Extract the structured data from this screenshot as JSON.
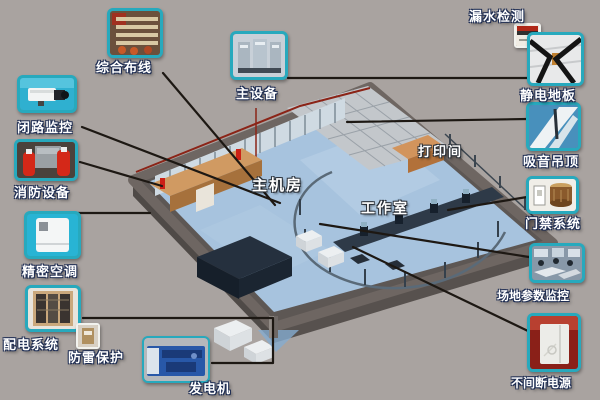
{
  "diagram": {
    "description": "isometric-machine-room-solution-diagram",
    "room_labels": {
      "main_room": "主机房",
      "work_room": "工作室",
      "print_room": "打印间"
    },
    "callouts": [
      {
        "id": "cabling",
        "label": "综合布线"
      },
      {
        "id": "cctv",
        "label": "闭路监控"
      },
      {
        "id": "fire",
        "label": "消防设备"
      },
      {
        "id": "ac",
        "label": "精密空调"
      },
      {
        "id": "power",
        "label": "配电系统"
      },
      {
        "id": "lightning",
        "label": "防雷保护"
      },
      {
        "id": "generator",
        "label": "发电机"
      },
      {
        "id": "main_equipment",
        "label": "主设备"
      },
      {
        "id": "leak",
        "label": "漏水检测"
      },
      {
        "id": "antistatic",
        "label": "静电地板"
      },
      {
        "id": "ceiling",
        "label": "吸音吊顶"
      },
      {
        "id": "access",
        "label": "门禁系统"
      },
      {
        "id": "site_monitor",
        "label": "场地参数监控"
      },
      {
        "id": "ups",
        "label": "不间断电源"
      }
    ],
    "colors": {
      "background": "#a9a3a0",
      "thumbnail_border": "#27a9bd",
      "connector_line": "#1d1813",
      "label_text": "#ffffff",
      "label_outline": "#1d2c52",
      "floor": "#a7c3de",
      "outer_wall": "#6e6662",
      "interior_wall": "#c98e58",
      "roof_edge_red": "#8b2417"
    }
  }
}
